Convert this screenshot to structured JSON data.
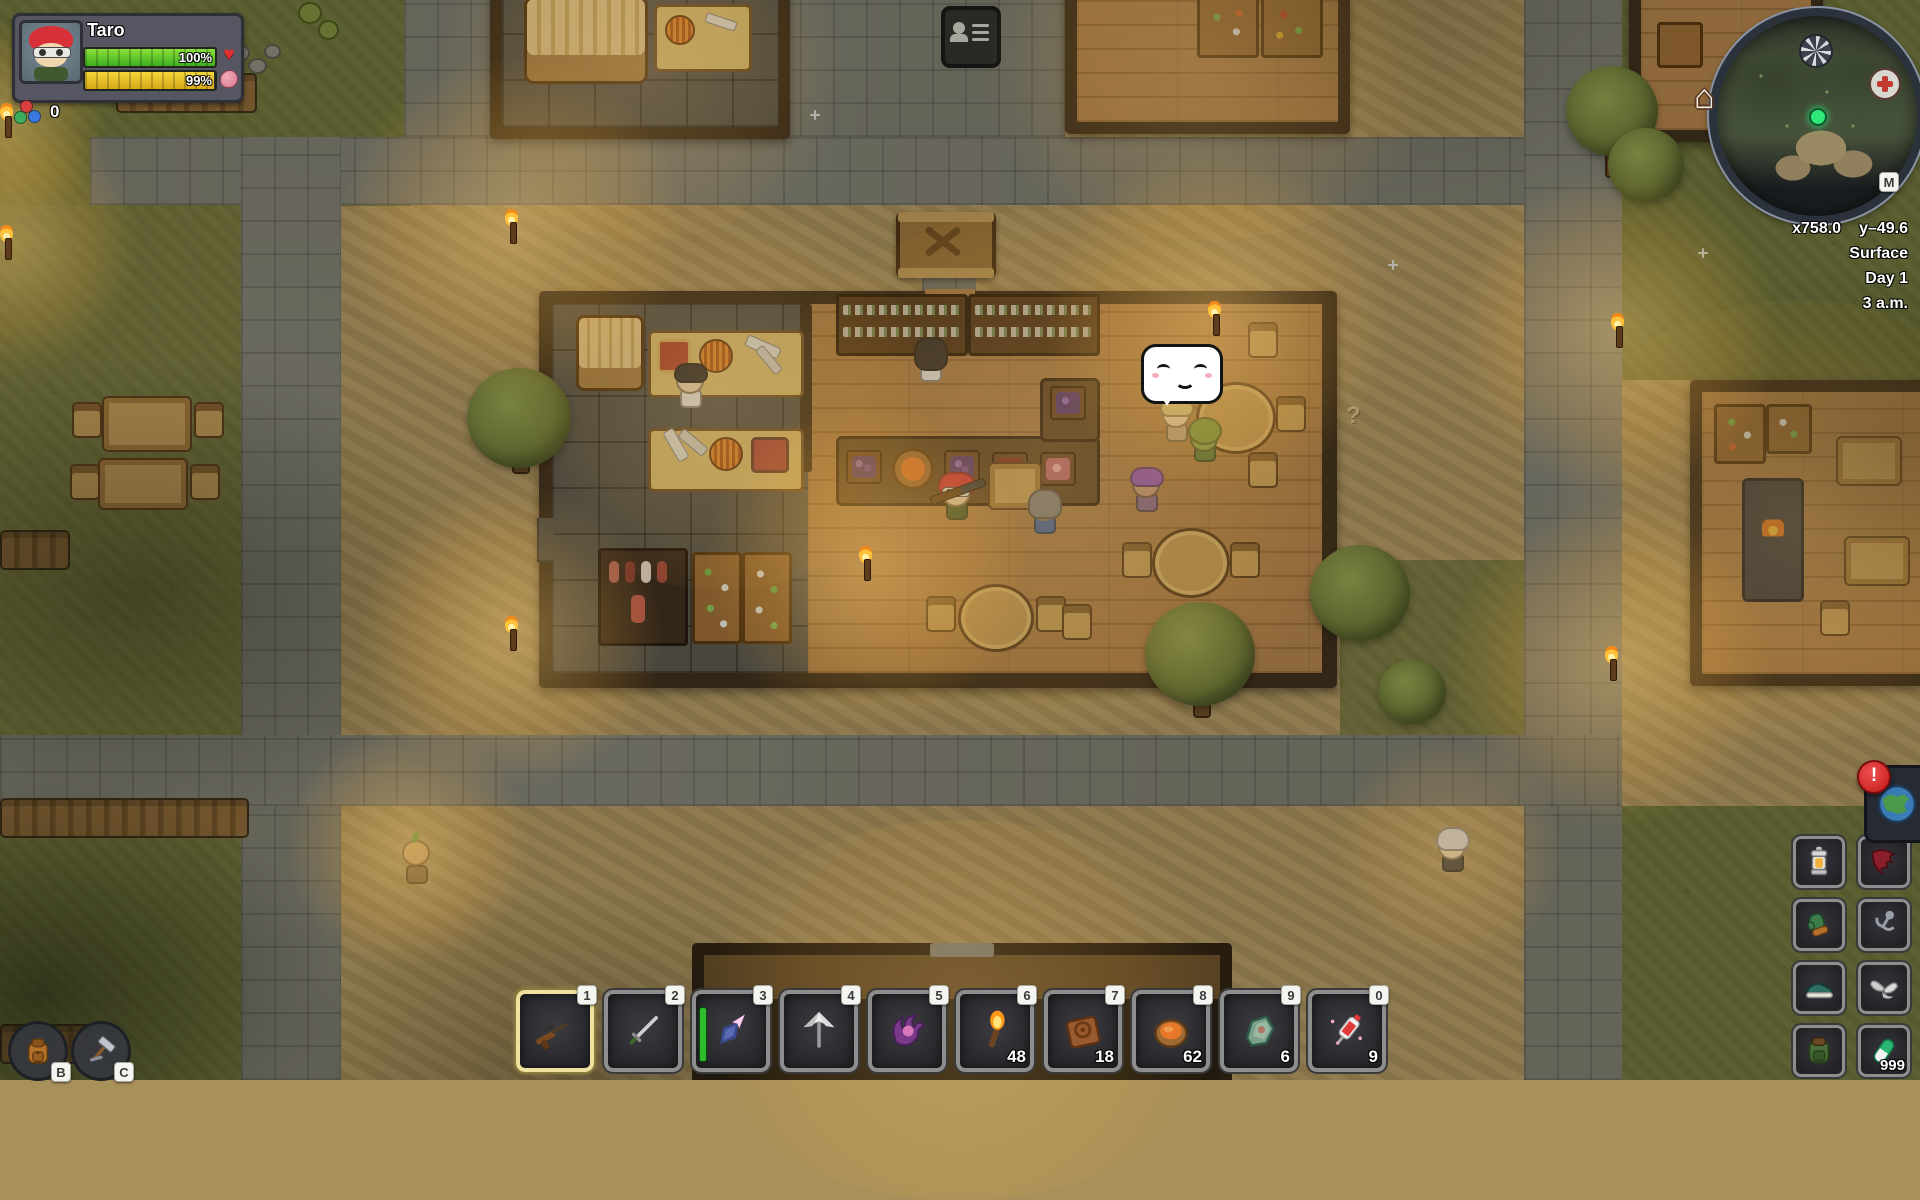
{
  "hud": {
    "player_name": "Taro",
    "health": {
      "value": "100%",
      "icon": "heart-icon",
      "icon_char": "♥"
    },
    "food": {
      "value": "99%",
      "icon": "stomach-icon"
    },
    "coins": {
      "count": "0",
      "icon": "coin-cluster-icon"
    }
  },
  "minimap": {
    "coord_x": "x758.0",
    "coord_y": "y–49.6",
    "layer": "Surface",
    "day": "Day 1",
    "time": "3 a.m.",
    "map_key_label": "M",
    "home_icon_char": "⌂",
    "icons": [
      "portal-spiral-icon",
      "medical-cross-icon",
      "home-icon",
      "player-marker"
    ]
  },
  "world": {
    "question_mark": "?",
    "speech_bubble": "happy-face-emote"
  },
  "hotbar": {
    "slots": [
      {
        "key": "1",
        "item": "hunting-rifle",
        "selected": true
      },
      {
        "key": "2",
        "item": "rapier",
        "selected": false
      },
      {
        "key": "3",
        "item": "crystal-spear",
        "selected": false,
        "durability": true
      },
      {
        "key": "4",
        "item": "iron-star-pickaxe",
        "selected": false
      },
      {
        "key": "5",
        "item": "void-claw",
        "selected": false
      },
      {
        "key": "6",
        "item": "torch",
        "count": "48",
        "selected": false
      },
      {
        "key": "7",
        "item": "cooked-meat",
        "count": "18",
        "selected": false
      },
      {
        "key": "8",
        "item": "soup-bowl",
        "count": "62",
        "selected": false
      },
      {
        "key": "9",
        "item": "ore-shard",
        "count": "6",
        "selected": false
      },
      {
        "key": "0",
        "item": "health-syringe",
        "count": "9",
        "selected": false
      }
    ]
  },
  "equipment": {
    "slots": [
      {
        "item": "lantern"
      },
      {
        "item": "red-cape"
      },
      {
        "item": "gloves"
      },
      {
        "item": "grappling-hook"
      },
      {
        "item": "shoes"
      },
      {
        "item": "silver-wings"
      },
      {
        "item": "backpack"
      },
      {
        "item": "health-capsule",
        "count": "999"
      }
    ]
  },
  "menu_buttons": [
    {
      "key": "B",
      "icon": "backpack-icon"
    },
    {
      "key": "C",
      "icon": "crafting-hammer-icon"
    }
  ],
  "world_button": {
    "icon": "globe-icon",
    "badge": "!"
  }
}
